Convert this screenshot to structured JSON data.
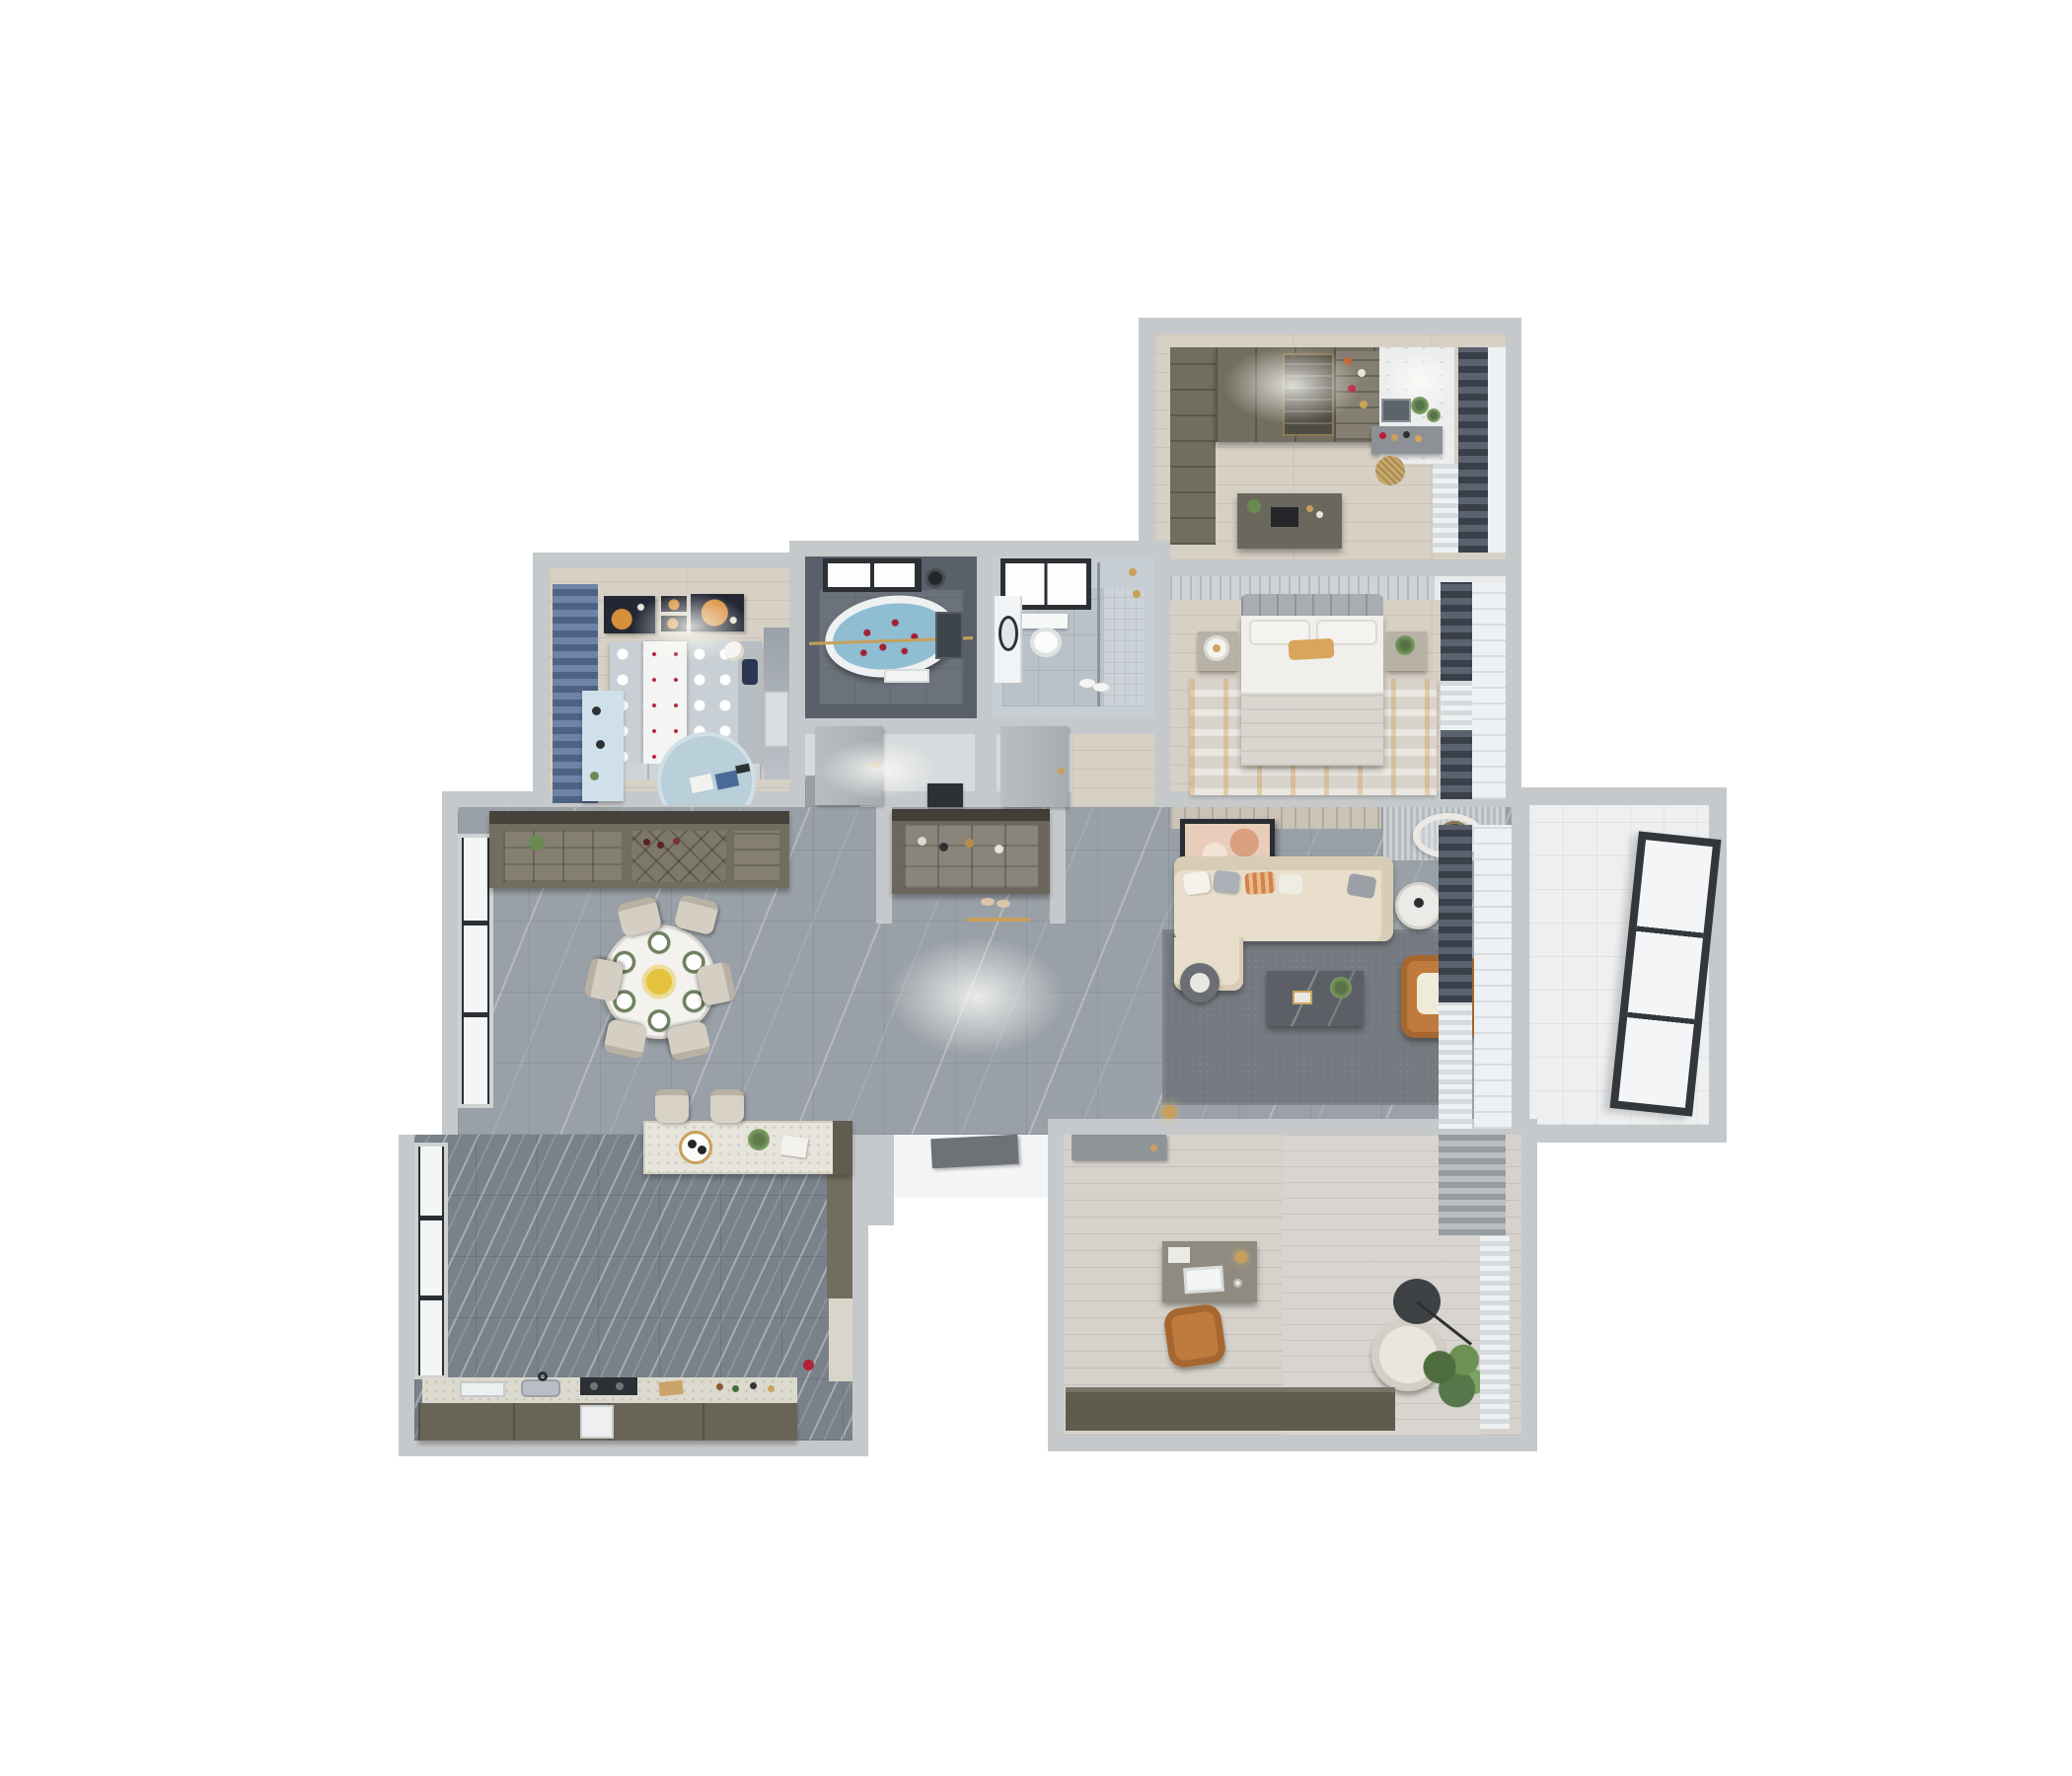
{
  "meta": {
    "title": "3D apartment floor plan — top-down render",
    "style": "photoreal axonometric cutaway"
  },
  "palette": {
    "wall": "#c6c9cb",
    "wallLight": "#e7e9ea",
    "marble": "#99a0a7",
    "tile": "#79818a",
    "wood": "#d7d0c5",
    "olive": "#716d5f",
    "oliveDark": "#5f5b4d",
    "cream": "#e8decb",
    "cognac": "#bf7a3e",
    "gold": "#c8a05a",
    "water": "#8fbdd1",
    "kidsBlue": "#b9cfd9",
    "curtainBlue": "#4e6283",
    "curtainDark": "#39404a",
    "rugLiving": "#757a81",
    "rugMaster": "#d8d3cb",
    "accentOrange": "#d78f3c",
    "artNavy": "#232733",
    "glass": "#f4f6f6"
  },
  "rooms": {
    "walkInCloset": {
      "label": "Walk-in closet",
      "items": {
        "wardrobe": "Wardrobe wall",
        "island": "Dresser island",
        "vanity": "Vanity with mirror",
        "basket": "Woven basket",
        "curtain": "Dark window curtains"
      }
    },
    "masterBedroom": {
      "label": "Master bedroom",
      "items": {
        "bed": "Double bed with tan accent pillow",
        "nightstandLeft": "Nightstand with white lamp",
        "nightstandRight": "Nightstand with plant",
        "rug": "Distressed orange-gray rug",
        "curtain": "Dark window curtains"
      }
    },
    "bathTub": {
      "label": "Master bathroom",
      "items": {
        "tub": "Oval freestanding tub with rose petals",
        "window": "Black framed window",
        "shower": "Rain shower head",
        "towel": "Towel rail"
      }
    },
    "bathGuest": {
      "label": "Guest bathroom",
      "items": {
        "toilet": "Wall-hung toilet",
        "vanity": "Washbasin counter",
        "shower": "Walk-in shower with brass fixtures",
        "window": "Black framed window",
        "slippers": "Slippers"
      }
    },
    "kidsRoom": {
      "label": "Kids bedroom",
      "items": {
        "bed": "Polka-dot bed with teddy bear",
        "desk": "Light-blue study desk",
        "rug": "Round play rug with toys",
        "wardrobe": "Wardrobe with toy niche",
        "art": "Orange planet wall art (4 frames)",
        "curtain": "Blue curtains"
      }
    },
    "hallway": {
      "label": "Hallway",
      "items": {
        "doorBath": "Bathroom door",
        "doorBedroom": "Bedroom door",
        "shelf": "Black console shelf"
      }
    },
    "diningRoom": {
      "label": "Dining room",
      "items": {
        "table": "Round dining table with 6 place settings and yellow centerpiece",
        "chairs": "6 beige dining chairs",
        "sideboard": "Wine sideboard with bottle racks",
        "window": "Floor-to-ceiling windows"
      }
    },
    "foyer": {
      "label": "Entry foyer",
      "items": {
        "console": "Recessed shoe console with decor niche",
        "mat": "Brass threshold strip",
        "slippers": "Slippers",
        "entryDoor": "Entrance door (ajar)"
      }
    },
    "livingRoom": {
      "label": "Living room",
      "items": {
        "sofa": "L-shaped cream sectional with pillows",
        "coffeeTable": "Dark marble coffee table with plant",
        "armchair": "Cognac leather armchair",
        "sideTable": "Round white side table",
        "smallTable": "Round dark side table",
        "tvArt": "Leaning framed artwork",
        "ceilingLamp": "Round ceiling lamp",
        "acVent": "Slatted ceiling vent",
        "rug": "Large gray rug",
        "curtain": "Dark drapes and sheers"
      }
    },
    "balcony": {
      "label": "Balcony",
      "items": {
        "window": "Panoramic black-framed window"
      }
    },
    "kitchen": {
      "label": "Kitchen",
      "items": {
        "island": "Terrazzo breakfast island with coffee tray and plant",
        "stools": "2 bar stools",
        "counter": "Counter with sink, cooktop and dishwasher",
        "tallCabinet": "Tall cabinet",
        "kettle": "Red kettle",
        "window": "Black framed windows"
      }
    },
    "office": {
      "label": "Home office",
      "items": {
        "desk": "Writing desk with laptop and brass lamp",
        "chair": "Cognac desk chair",
        "lounge": "Round lounge chair",
        "lamp": "Black arc floor lamp",
        "plant": "Potted plant",
        "cabinet": "Low olive cabinet",
        "door": "Gray sliding door",
        "curtain": "Gray drapes and sheers"
      }
    }
  }
}
